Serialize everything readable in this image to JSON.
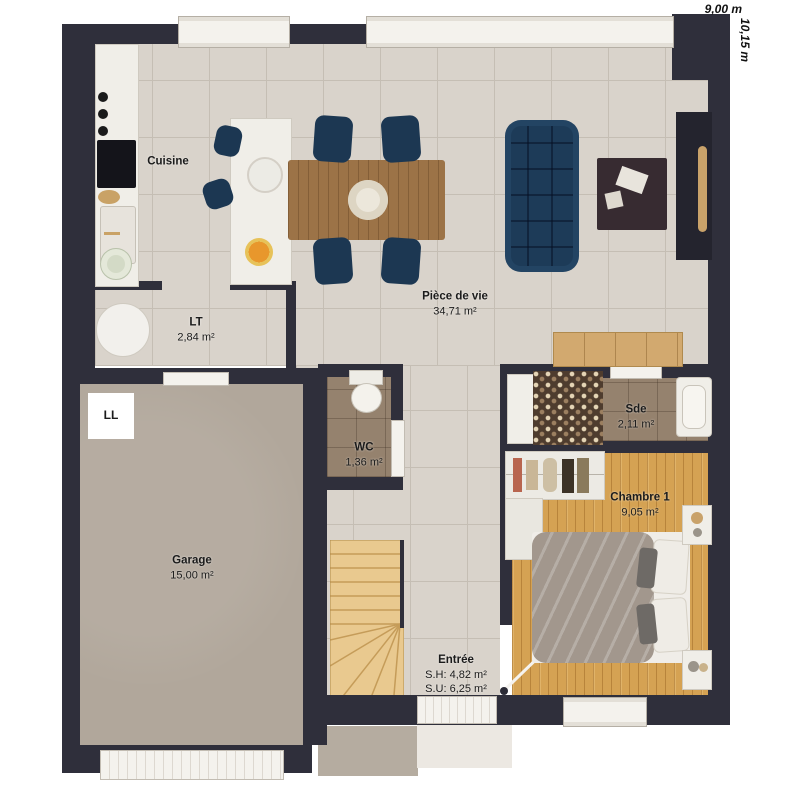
{
  "dimensions": {
    "width": "9,00 m",
    "depth": "10,15 m"
  },
  "rooms": {
    "cuisine": {
      "name": "Cuisine"
    },
    "piece_de_vie": {
      "name": "Pièce de vie",
      "area": "34,71 m²"
    },
    "lt": {
      "name": "LT",
      "area": "2,84 m²"
    },
    "wc": {
      "name": "WC",
      "area": "1,36 m²"
    },
    "sde": {
      "name": "Sde",
      "area": "2,11 m²"
    },
    "chambre1": {
      "name": "Chambre 1",
      "area": "9,05 m²"
    },
    "garage": {
      "name": "Garage",
      "area": "15,00 m²"
    },
    "entree": {
      "name": "Entrée",
      "area_sh": "S.H: 4,82 m²",
      "area_su": "S.U: 6,25 m²"
    }
  },
  "appliances": {
    "washing_machine_label": "LL"
  },
  "colors": {
    "wall": "#2f2f3b",
    "tile_floor": "#d9d3cb",
    "wood_floor": "#d5a253",
    "garage_floor": "#b1a79b",
    "wet_room_floor": "#95826e",
    "sofa_navy": "#1d3b58",
    "table_wood": "#9c7347",
    "stair_wood": "#e9c98f"
  }
}
